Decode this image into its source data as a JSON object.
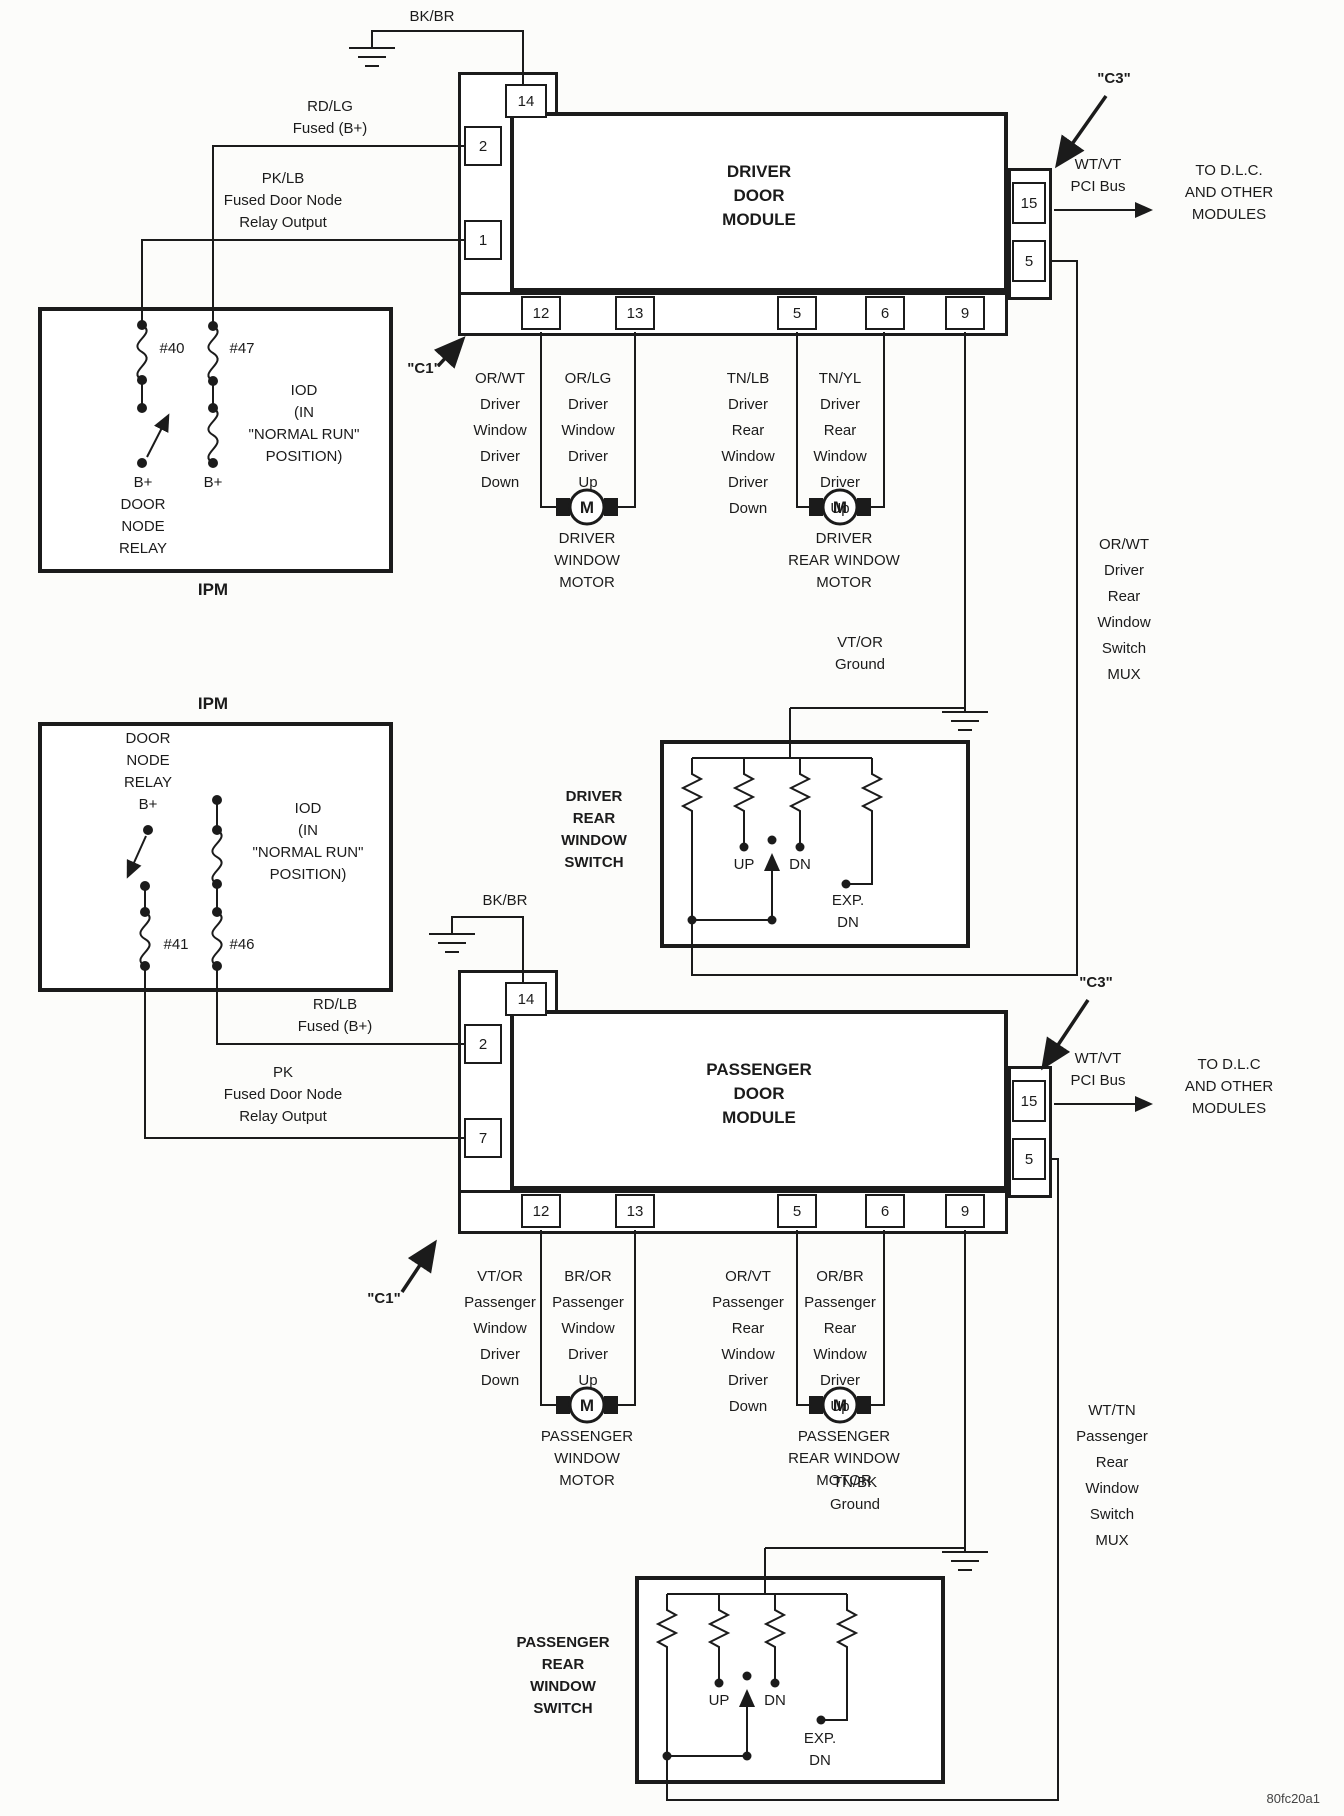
{
  "symbols": {
    "motor": "M"
  },
  "footer_code": "80fc20a1",
  "ipm_top": {
    "title": "IPM",
    "fuse_left": "#40",
    "fuse_right": "#47",
    "bplus_left": "B+",
    "bplus_right": "B+",
    "relay_label": "B+\nDOOR\nNODE\nRELAY",
    "iod_label": "IOD\n(IN\n\"NORMAL RUN\"\nPOSITION)"
  },
  "ipm_bottom": {
    "title": "IPM",
    "fuse_left": "#41",
    "fuse_right": "#46",
    "relay_label": "DOOR\nNODE\nRELAY\nB+",
    "iod_label": "IOD\n(IN\n\"NORMAL RUN\"\nPOSITION)"
  },
  "driver": {
    "ground_feed": "BK/BR",
    "connector_c1": "\"C1\"",
    "connector_c3": "\"C3\"",
    "module_title": "DRIVER\nDOOR\nMODULE",
    "pins": {
      "p14": "14",
      "p2": "2",
      "p1": "1",
      "p12": "12",
      "p13": "13",
      "p5": "5",
      "p6": "6",
      "p9": "9",
      "p15": "15",
      "p5r": "5"
    },
    "feed_b_label": "RD/LG\nFused (B+)",
    "relay_feed_label": "PK/LB\nFused Door Node\nRelay Output",
    "pci_label": "WT/VT\nPCI Bus",
    "pci_dest": "TO D.L.C.\nAND OTHER\nMODULES",
    "wire_window_down": "OR/WT\nDriver\nWindow\nDriver\nDown",
    "wire_window_up": "OR/LG\nDriver\nWindow\nDriver\nUp",
    "wire_rear_down": "TN/LB\nDriver\nRear\nWindow\nDriver\nDown",
    "wire_rear_up": "TN/YL\nDriver\nRear\nWindow\nDriver\nUp",
    "motor_front": "DRIVER\nWINDOW\nMOTOR",
    "motor_rear": "DRIVER\nREAR WINDOW\nMOTOR",
    "ground_wire": "VT/OR\nGround",
    "mux_label": "OR/WT\nDriver\nRear\nWindow\nSwitch\nMUX",
    "switch_label": "DRIVER\nREAR\nWINDOW\nSWITCH",
    "switch_up": "UP",
    "switch_dn": "DN",
    "switch_exp": "EXP.\nDN"
  },
  "passenger": {
    "ground_feed": "BK/BR",
    "connector_c1": "\"C1\"",
    "connector_c3": "\"C3\"",
    "module_title": "PASSENGER\nDOOR\nMODULE",
    "pins": {
      "p14": "14",
      "p2": "2",
      "p7": "7",
      "p12": "12",
      "p13": "13",
      "p5": "5",
      "p6": "6",
      "p9": "9",
      "p15": "15",
      "p5r": "5"
    },
    "feed_b_label": "RD/LB\nFused (B+)",
    "relay_feed_label": "PK\nFused Door Node\nRelay Output",
    "pci_label": "WT/VT\nPCI Bus",
    "pci_dest": "TO D.L.C\nAND OTHER\nMODULES",
    "wire_window_down": "VT/OR\nPassenger\nWindow\nDriver\nDown",
    "wire_window_up": "BR/OR\nPassenger\nWindow\nDriver\nUp",
    "wire_rear_down": "OR/VT\nPassenger\nRear\nWindow\nDriver\nDown",
    "wire_rear_up": "OR/BR\nPassenger\nRear\nWindow\nDriver\nUp",
    "motor_front": "PASSENGER\nWINDOW\nMOTOR",
    "motor_rear": "PASSENGER\nREAR WINDOW\nMOTOR",
    "ground_wire": "TN/BK\nGround",
    "mux_label": "WT/TN\nPassenger\nRear\nWindow\nSwitch\nMUX",
    "switch_label": "PASSENGER\nREAR\nWINDOW\nSWITCH",
    "switch_up": "UP",
    "switch_dn": "DN",
    "switch_exp": "EXP.\nDN"
  }
}
